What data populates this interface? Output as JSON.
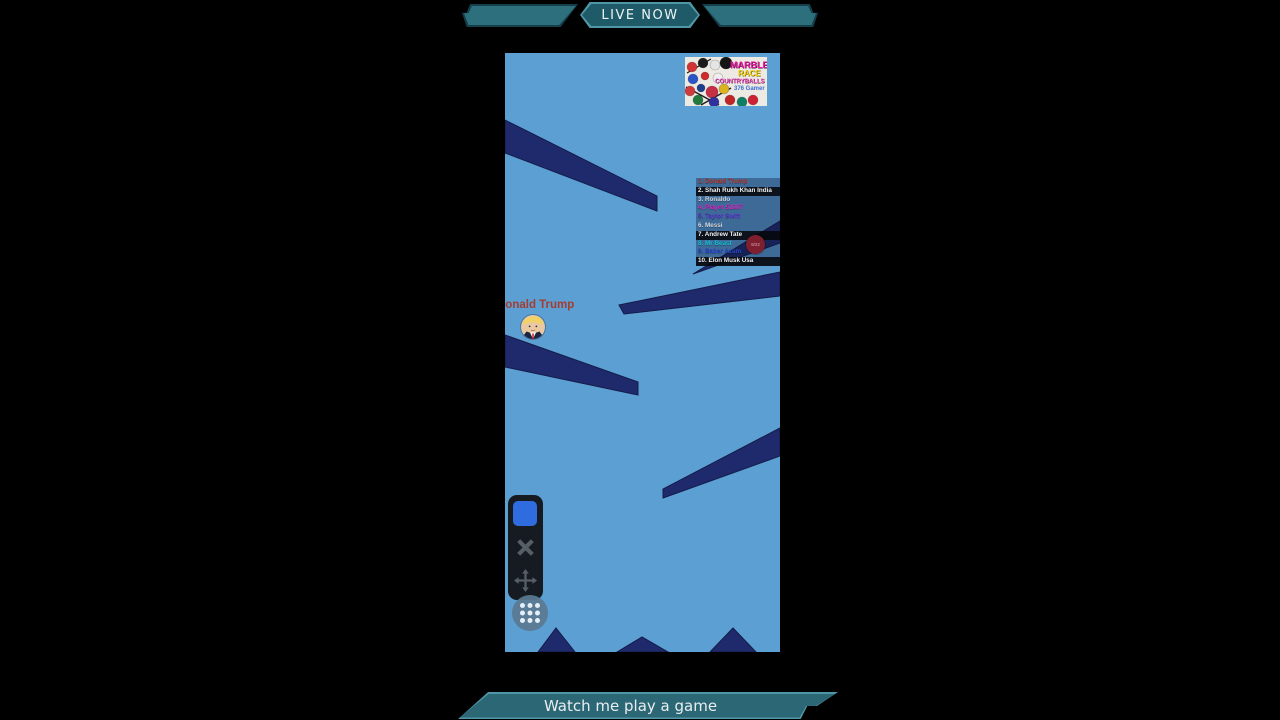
{
  "banner_top": {
    "live_label": "LIVE NOW"
  },
  "banner_bottom": {
    "label": "Watch me play a game"
  },
  "game": {
    "player": {
      "name": "Donald Trump"
    },
    "leaderboard": {
      "rows": [
        {
          "label": "1. Donald Trump",
          "color": "#b5372b",
          "bg": "rgba(13,22,54,0.38)"
        },
        {
          "label": "2. Shah Rukh Khan India",
          "color": "#f2f2f2",
          "bg": "rgba(5,6,12,0.92)"
        },
        {
          "label": "3. Ronaldo",
          "color": "#ccd3da",
          "bg": "rgba(13,22,54,0.38)"
        },
        {
          "label": "4. Player 51007",
          "color": "#e021c4",
          "bg": "rgba(13,22,54,0.38)"
        },
        {
          "label": "5. Taylor Swift",
          "color": "#5a35cf",
          "bg": "rgba(13,22,54,0.38)"
        },
        {
          "label": "6. Messi",
          "color": "#d5dbe2",
          "bg": "rgba(13,22,54,0.38)"
        },
        {
          "label": "7. Andrew Tate",
          "color": "#f2f2f2",
          "bg": "rgba(5,6,12,0.92)"
        },
        {
          "label": "8. Mr Beast",
          "color": "#14c2d8",
          "bg": "rgba(13,22,54,0.38)"
        },
        {
          "label": "9. Babar Azam",
          "color": "#2547cc",
          "bg": "rgba(13,22,54,0.38)"
        },
        {
          "label": "10. Elon Musk Usa",
          "color": "#f2f2f2",
          "bg": "rgba(5,6,12,0.92)"
        }
      ],
      "badge": "9/22"
    },
    "thumbnail": {
      "title1": "MARBLE",
      "title2": "RACE",
      "title3": "COUNTRYBALLS",
      "subtitle": "376 Gamer",
      "balls": [
        {
          "x": 7,
          "y": 10,
          "r": 5,
          "c": "#d23333"
        },
        {
          "x": 18,
          "y": 6,
          "r": 5,
          "c": "#1b1b1b"
        },
        {
          "x": 30,
          "y": 8,
          "r": 5,
          "c": "#e5e5e5"
        },
        {
          "x": 41,
          "y": 6,
          "r": 6,
          "c": "#141414"
        },
        {
          "x": 8,
          "y": 22,
          "r": 5,
          "c": "#2a55c8"
        },
        {
          "x": 20,
          "y": 19,
          "r": 4,
          "c": "#cf2b2b"
        },
        {
          "x": 33,
          "y": 21,
          "r": 5,
          "c": "#efefef"
        },
        {
          "x": 5,
          "y": 34,
          "r": 5,
          "c": "#cf3a3a"
        },
        {
          "x": 16,
          "y": 31,
          "r": 4,
          "c": "#1c3e8e"
        },
        {
          "x": 27,
          "y": 35,
          "r": 6,
          "c": "#c62f44"
        },
        {
          "x": 39,
          "y": 32,
          "r": 5,
          "c": "#dcb31e"
        },
        {
          "x": 13,
          "y": 43,
          "r": 5,
          "c": "#1f7a3c"
        },
        {
          "x": 29,
          "y": 45,
          "r": 5,
          "c": "#30309e"
        },
        {
          "x": 45,
          "y": 43,
          "r": 5,
          "c": "#c02424"
        },
        {
          "x": 57,
          "y": 45,
          "r": 5,
          "c": "#0f7f63"
        },
        {
          "x": 68,
          "y": 43,
          "r": 5,
          "c": "#cc2233"
        }
      ],
      "lines": [
        {
          "x1": 2,
          "y1": 16,
          "x2": 26,
          "y2": 2
        },
        {
          "x1": 1,
          "y1": 30,
          "x2": 34,
          "y2": 48
        },
        {
          "x1": 16,
          "y1": 48,
          "x2": 46,
          "y2": 31
        }
      ]
    },
    "controls": {
      "icons": [
        {
          "name": "shape-button",
          "glyph": "■"
        },
        {
          "name": "close-icon",
          "glyph": "✕"
        },
        {
          "name": "move-icon",
          "glyph": "✥"
        },
        {
          "name": "grid-dots-icon",
          "glyph": "⠿"
        }
      ]
    }
  },
  "colors": {
    "bg": "#000000",
    "banner_dark": "#15404b",
    "banner_fill": "#2e6f7d",
    "banner_border": "#4f97a6",
    "banner_inner": "#1f5a68",
    "banner_inner2": "#2b6775",
    "game_bg": "#5c9fd3",
    "ramp": "#1e2a6b",
    "ramp_edge": "#141c49",
    "name_color": "#a33d31",
    "panel_bg": "#151b21",
    "blue_btn": "#2f6ce0",
    "icon_gray": "#565e66",
    "grid_btn": "#5a7a92"
  }
}
